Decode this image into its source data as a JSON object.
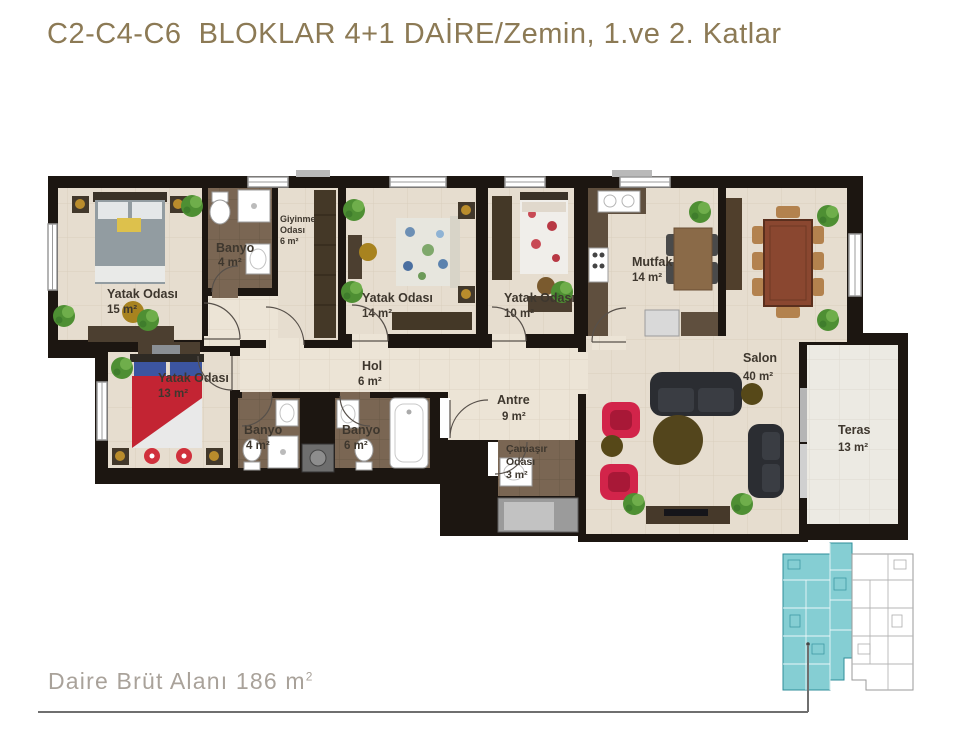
{
  "title": "C2-C4-C6  BLOKLAR 4+1 DAİRE/Zemin, 1.ve 2. Katlar",
  "plan": {
    "rooms": {
      "yatak15": {
        "name": "Yatak Odası",
        "area": "15 m²"
      },
      "banyo_ust": {
        "name": "Banyo",
        "area": "4 m²"
      },
      "giyinme": {
        "line1": "Giyinme",
        "line2": "Odası",
        "area": "6 m²"
      },
      "yatak14": {
        "name": "Yatak Odası",
        "area": "14 m²"
      },
      "yatak10": {
        "name": "Yatak Odası",
        "area": "10 m²"
      },
      "mutfak": {
        "name": "Mutfak",
        "area": "14 m²"
      },
      "salon": {
        "name": "Salon",
        "area": "40 m²"
      },
      "teras": {
        "name": "Teras",
        "area": "13 m²"
      },
      "hol": {
        "name": "Hol",
        "area": "6 m²"
      },
      "antre": {
        "name": "Antre",
        "area": "9 m²"
      },
      "yatak13": {
        "name": "Yatak Odası",
        "area": "13 m²"
      },
      "banyo4": {
        "name": "Banyo",
        "area": "4 m²"
      },
      "banyo6": {
        "name": "Banyo",
        "area": "6 m²"
      },
      "camasir": {
        "line1": "Çamaşır",
        "line2": "Odası",
        "area": "3 m²"
      }
    }
  },
  "footer": {
    "gross_area_text": "Daire Brüt Alanı 186 m",
    "gross_area_sup": "2"
  },
  "colors": {
    "title_gold": "#8C7A55",
    "footer_gray": "#A9A29A",
    "wall_black": "#1C1611",
    "floor_cream": "#E6DDCF",
    "floor_hall": "#ECE4D6",
    "floor_bath_brown": "#7A6653",
    "floor_teras": "#ECEAE3",
    "furniture_darkwood": "#483B2C",
    "dining_table_wood": "#8A4730",
    "chair_tan": "#B3824E",
    "sofa_dark": "#2B2D32",
    "armchair_red": "#D2244A",
    "plant_green": "#4E8F33",
    "keyplan_teal": "#85CED3"
  }
}
